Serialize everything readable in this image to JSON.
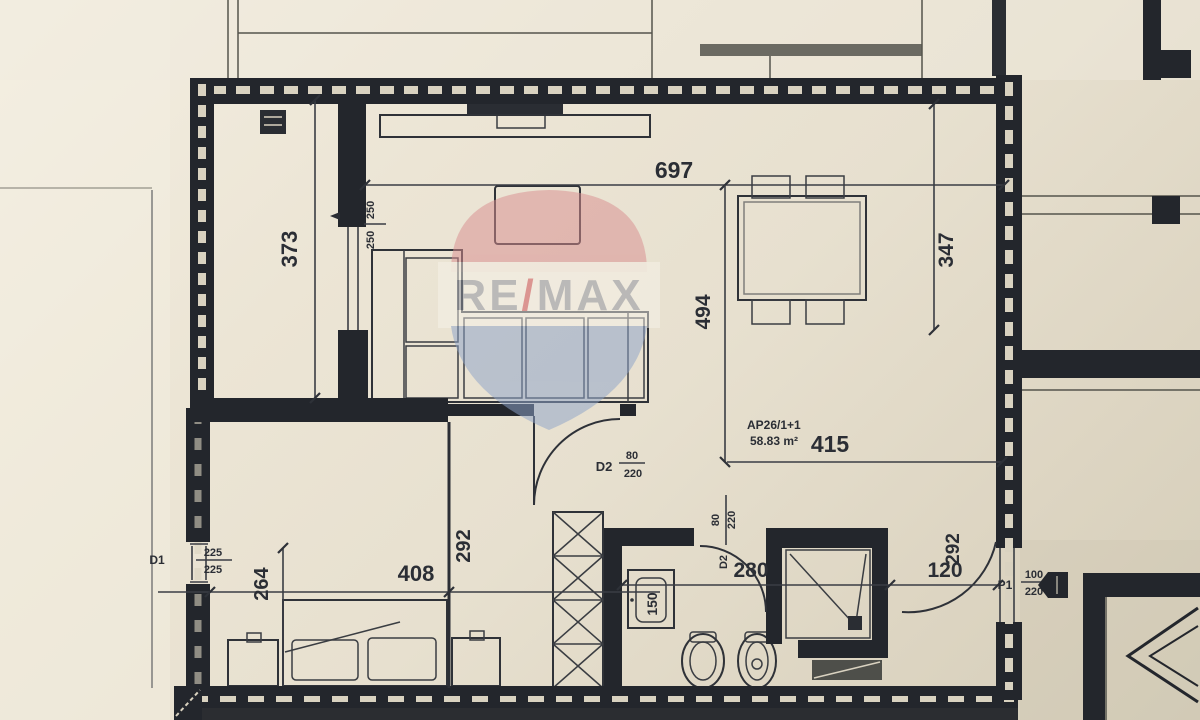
{
  "unit": {
    "code": "AP26/1+1",
    "area": "58.83 m²"
  },
  "watermark": {
    "re": "RE",
    "slash": "/",
    "max": "MAX"
  },
  "dims": {
    "top_width": "697",
    "left_strip_height": "373",
    "right_top_height": "347",
    "living_height": "494",
    "living_width": "415",
    "hall_height": "292",
    "bedroom_width": "408",
    "bedroom_depth": "264",
    "bath_width": "280",
    "passage_width": "120",
    "passage_height": "292",
    "sink_width": "150",
    "window_width": "250",
    "window_height": "250"
  },
  "openings": {
    "d1": {
      "label": "D1",
      "width": "225",
      "height": "225"
    },
    "d2_entry": {
      "label": "D2",
      "width": "80",
      "height": "220"
    },
    "d2_bath": {
      "label": "D2",
      "width": "80",
      "height": "220"
    },
    "p1": {
      "label": "P1",
      "width": "100",
      "height": "220"
    }
  },
  "colors": {
    "paper": "#e9e2d2",
    "wall": "#23262c",
    "ink": "#2b2e35",
    "remax_red": "#d98d90",
    "remax_blue": "#8ea3c9",
    "remax_slash": "#cf4f57",
    "remax_text": "#9094a1"
  }
}
